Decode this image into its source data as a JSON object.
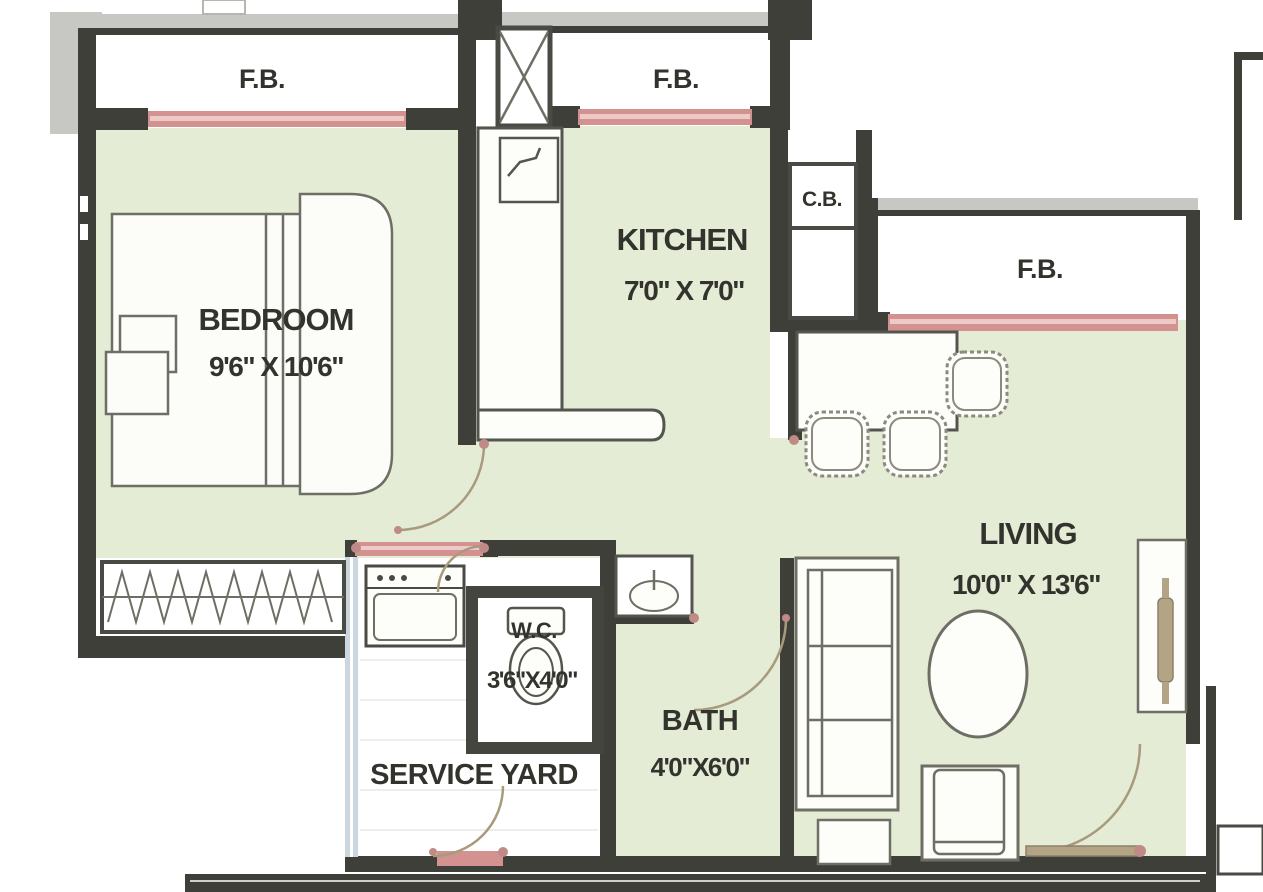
{
  "plan": {
    "title": "1 BHK apartment floor plan",
    "balconies": {
      "fb_top_left": "F.B.",
      "fb_top_mid": "F.B.",
      "fb_right": "F.B."
    },
    "cupboard": {
      "label": "C.B."
    },
    "rooms": {
      "bedroom": {
        "name": "BEDROOM",
        "dims": "9'6\" X 10'6\""
      },
      "kitchen": {
        "name": "KITCHEN",
        "dims": "7'0\" X 7'0\""
      },
      "living": {
        "name": "LIVING",
        "dims": "10'0\" X 13'6\""
      },
      "wc": {
        "name": "W.C.",
        "dims": "3'6\"X4'0\""
      },
      "bath": {
        "name": "BATH",
        "dims": "4'0\"X6'0\""
      },
      "service_yard": {
        "name": "SERVICE YARD"
      }
    },
    "colors": {
      "floor_green": "#e5ecd6",
      "wall_dark": "#3f3f3a",
      "window_pink": "#d3928f",
      "window_pink_light": "#edc9c7",
      "outer_gray": "#c7c7c3",
      "door_tan": "#b3a485",
      "glass_blue": "#ccd6de",
      "furniture_stroke": "#6e6e64",
      "label_dark": "#33332e"
    }
  }
}
